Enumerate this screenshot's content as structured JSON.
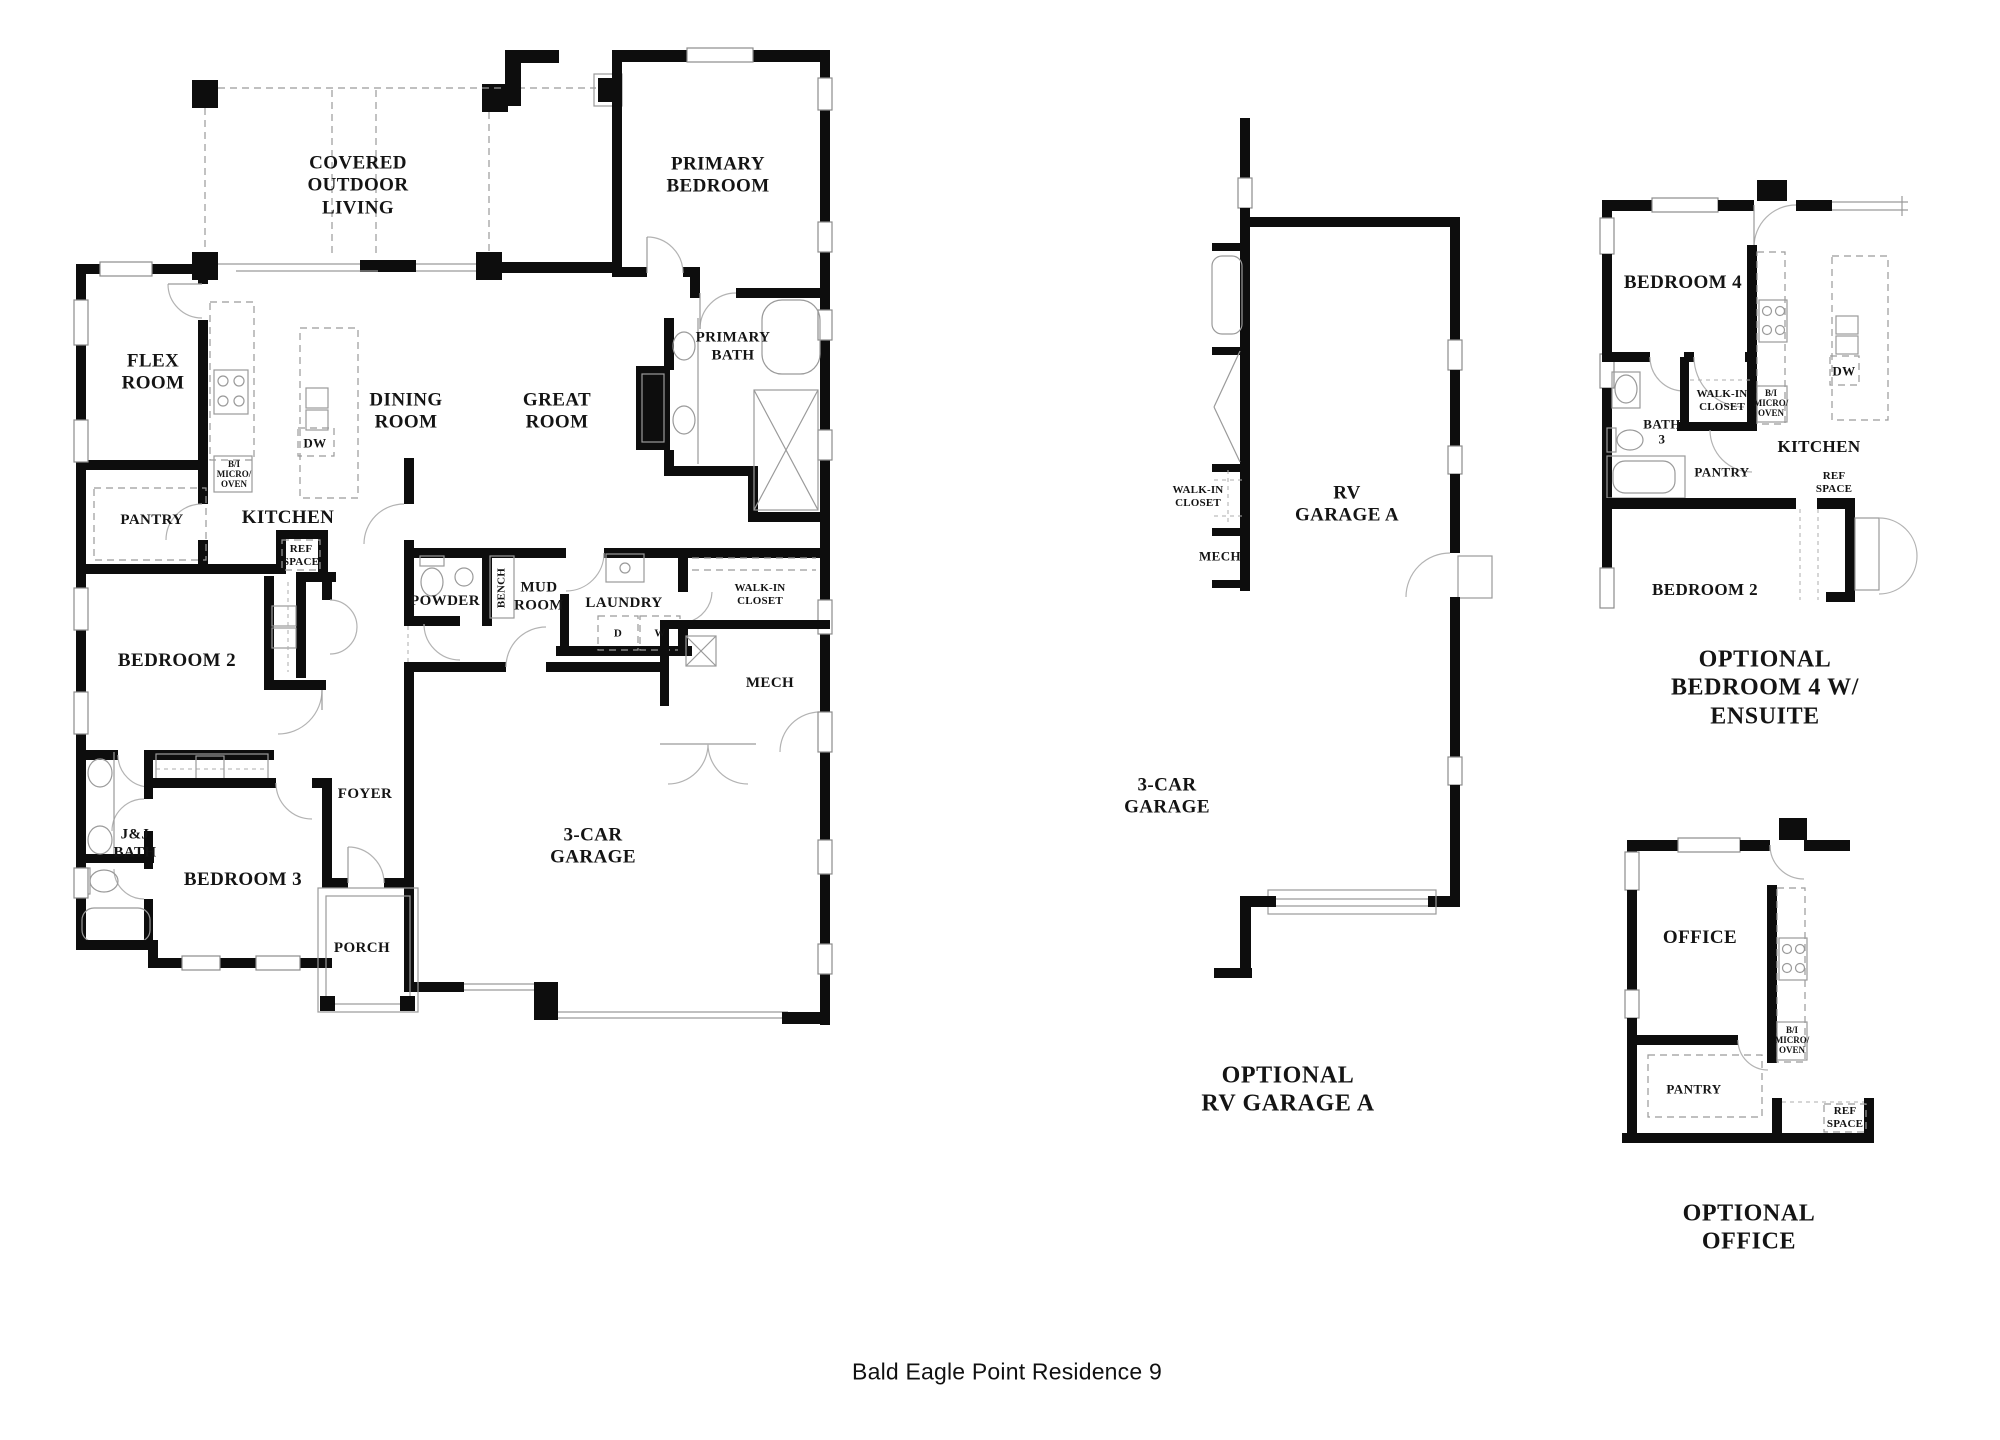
{
  "title": "Bald Eagle Point Residence 9",
  "main_plan": {
    "covered_outdoor_living": [
      "COVERED",
      "OUTDOOR",
      "LIVING"
    ],
    "primary_bedroom": [
      "PRIMARY",
      "BEDROOM"
    ],
    "primary_bath": [
      "PRIMARY",
      "BATH"
    ],
    "flex_room": [
      "FLEX",
      "ROOM"
    ],
    "dining_room": [
      "DINING",
      "ROOM"
    ],
    "great_room": [
      "GREAT",
      "ROOM"
    ],
    "kitchen": "KITCHEN",
    "pantry": "PANTRY",
    "ref_space": [
      "REF",
      "SPACE"
    ],
    "bi_micro_oven": [
      "B/I",
      "MICRO/",
      "OVEN"
    ],
    "dw": "DW",
    "bedroom_2": "BEDROOM 2",
    "bedroom_3": "BEDROOM 3",
    "jj_bath": [
      "J&J",
      "BATH"
    ],
    "powder": "POWDER",
    "bench": "BENCH",
    "mud_room": [
      "MUD",
      "ROOM"
    ],
    "laundry": "LAUNDRY",
    "dryer": "D",
    "washer": "W",
    "walk_in_closet": [
      "WALK-IN",
      "CLOSET"
    ],
    "mech": "MECH",
    "foyer": "FOYER",
    "porch": "PORCH",
    "garage": [
      "3-CAR",
      "GARAGE"
    ]
  },
  "rv_garage_option": {
    "walk_in_closet": [
      "WALK-IN",
      "CLOSET"
    ],
    "mech": "MECH",
    "rv_garage": [
      "RV",
      "GARAGE A"
    ],
    "garage": [
      "3-CAR",
      "GARAGE"
    ],
    "caption": [
      "OPTIONAL",
      "RV GARAGE A"
    ]
  },
  "bedroom4_option": {
    "bedroom_4": "BEDROOM 4",
    "bath_3": [
      "BATH",
      "3"
    ],
    "walk_in_closet": [
      "WALK-IN",
      "CLOSET"
    ],
    "bi_micro_oven": [
      "B/I",
      "MICRO/",
      "OVEN"
    ],
    "pantry": "PANTRY",
    "kitchen": "KITCHEN",
    "ref_space": [
      "REF",
      "SPACE"
    ],
    "dw": "DW",
    "bedroom_2": "BEDROOM 2",
    "caption": [
      "OPTIONAL",
      "BEDROOM 4 W/",
      "ENSUITE"
    ]
  },
  "office_option": {
    "office": "OFFICE",
    "pantry": "PANTRY",
    "bi_micro_oven": [
      "B/I",
      "MICRO/",
      "OVEN"
    ],
    "ref_space": [
      "REF",
      "SPACE"
    ],
    "caption": [
      "OPTIONAL",
      "OFFICE"
    ]
  }
}
